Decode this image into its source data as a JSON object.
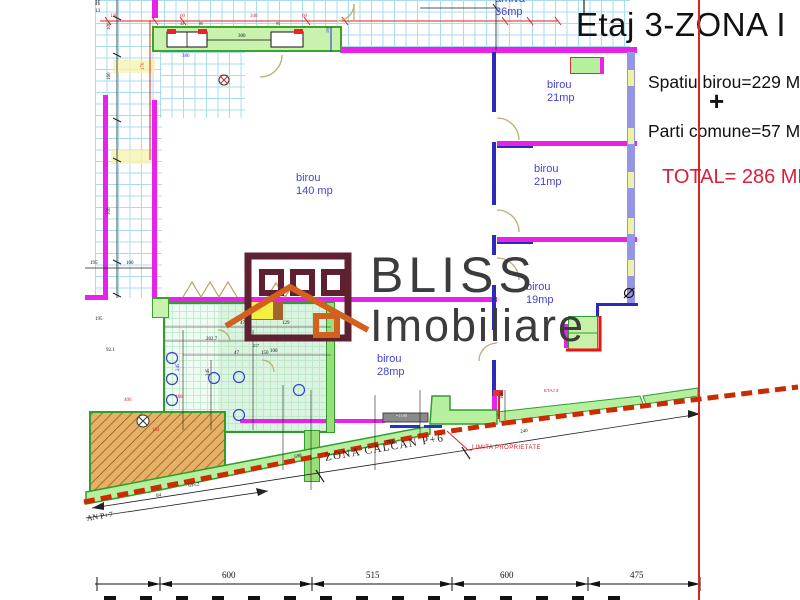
{
  "palette": {
    "magenta": "#e822e8",
    "wallblue": "#2b2bb8",
    "periwinkle": "#9595e6",
    "window": "#eef2a4",
    "grid": "#aadcf0",
    "tile": "#c5ecd0",
    "greenwall": "#b6ef9e",
    "greenborder": "#2f9e2f",
    "red": "#dd2222",
    "dashred": "#cc2a00",
    "tan": "#bfae74",
    "labelblue": "#4343cf",
    "maroon": "#5f2030",
    "orange": "#d2601e",
    "graytext": "#3c3c3c",
    "stairs": "#e5b167",
    "yellow": "#f3ef43"
  },
  "title_block": {
    "title": "Etaj 3-ZONA I",
    "line1": "Spatiu birou=229 MP",
    "plus": "+",
    "line2": "Parti comune=57 MP",
    "total": "TOTAL= 286 MP"
  },
  "watermark": {
    "brand": "BLISS",
    "brand2": "Imobiliare"
  },
  "rooms": [
    {
      "name": "arhiva",
      "area": "36mp"
    },
    {
      "name": "birou",
      "area": "21mp"
    },
    {
      "name": "birou",
      "area": "21mp"
    },
    {
      "name": "birou",
      "area": "19mp"
    },
    {
      "name": "birou",
      "area": "140 mp"
    },
    {
      "name": "birou",
      "area": "28mp"
    }
  ],
  "zone_labels": {
    "calcan": "ZONA CALCAN P+6",
    "limita": "LIMITA PROPRIETATE",
    "an_p7": "AN P+7",
    "etaj": "ETAJ 3"
  },
  "bottom_dims": [
    "600",
    "515",
    "600",
    "475"
  ],
  "annotations": [
    {
      "t": "H",
      "x": 95,
      "y": 0,
      "c": "#111",
      "s": 7
    },
    {
      "t": "13",
      "x": 95,
      "y": 9,
      "c": "#111",
      "s": 5
    },
    {
      "t": "130",
      "x": 110,
      "y": 14,
      "c": "#dd2222",
      "s": 5
    },
    {
      "t": "60",
      "x": 180,
      "y": 14,
      "c": "#dd2222",
      "s": 5
    },
    {
      "t": "346",
      "x": 250,
      "y": 14,
      "c": "#dd2222",
      "s": 5
    },
    {
      "t": "60",
      "x": 302,
      "y": 14,
      "c": "#dd2222",
      "s": 5
    },
    {
      "t": "300",
      "x": 238,
      "y": 34,
      "c": "#111",
      "s": 5
    },
    {
      "t": "43",
      "x": 180,
      "y": 22,
      "c": "#111",
      "s": 4
    },
    {
      "t": "85",
      "x": 199,
      "y": 22,
      "c": "#111",
      "s": 4
    },
    {
      "t": "95",
      "x": 276,
      "y": 22,
      "c": "#111",
      "s": 4
    },
    {
      "t": "170",
      "x": 141,
      "y": 70,
      "c": "#dd2222",
      "s": 5,
      "r": -90
    },
    {
      "t": "380",
      "x": 182,
      "y": 54,
      "c": "#2233cc",
      "s": 5
    },
    {
      "t": "100",
      "x": 107,
      "y": 30,
      "c": "#111",
      "s": 5,
      "r": -90
    },
    {
      "t": "160",
      "x": 107,
      "y": 80,
      "c": "#111",
      "s": 5,
      "r": -90
    },
    {
      "t": "100",
      "x": 107,
      "y": 215,
      "c": "#111",
      "s": 5,
      "r": -90
    },
    {
      "t": "100",
      "x": 326,
      "y": 33,
      "c": "#2233cc",
      "s": 4,
      "r": -90
    },
    {
      "t": "195",
      "x": 90,
      "y": 261,
      "c": "#111",
      "s": 5
    },
    {
      "t": "100",
      "x": 126,
      "y": 261,
      "c": "#111",
      "s": 5
    },
    {
      "t": "470",
      "x": 240,
      "y": 321,
      "c": "#111",
      "s": 5
    },
    {
      "t": "202.7",
      "x": 206,
      "y": 337,
      "c": "#111",
      "s": 5
    },
    {
      "t": "80",
      "x": 256,
      "y": 337,
      "c": "#111",
      "s": 5
    },
    {
      "t": "217",
      "x": 253,
      "y": 344,
      "c": "#111",
      "s": 4
    },
    {
      "t": "47",
      "x": 234,
      "y": 351,
      "c": "#111",
      "s": 5
    },
    {
      "t": "150",
      "x": 261,
      "y": 351,
      "c": "#111",
      "s": 5
    },
    {
      "t": "129",
      "x": 282,
      "y": 321,
      "c": "#111",
      "s": 5
    },
    {
      "t": "100",
      "x": 270,
      "y": 349,
      "c": "#111",
      "s": 5
    },
    {
      "t": "345",
      "x": 206,
      "y": 376,
      "c": "#111",
      "s": 5,
      "r": -90
    },
    {
      "t": "245",
      "x": 176,
      "y": 371,
      "c": "#2233cc",
      "s": 5,
      "r": -90
    },
    {
      "t": "92.1",
      "x": 106,
      "y": 348,
      "c": "#111",
      "s": 5
    },
    {
      "t": "195",
      "x": 95,
      "y": 317,
      "c": "#111",
      "s": 5
    },
    {
      "t": "400",
      "x": 124,
      "y": 398,
      "c": "#dd2222",
      "s": 5
    },
    {
      "t": "166",
      "x": 175,
      "y": 395,
      "c": "#dd2222",
      "s": 5
    },
    {
      "t": "104",
      "x": 152,
      "y": 428,
      "c": "#dd2222",
      "s": 5
    },
    {
      "t": "=11.00",
      "x": 396,
      "y": 414,
      "c": "#f2f2f2",
      "s": 4
    },
    {
      "t": "100",
      "x": 500,
      "y": 399,
      "c": "#111",
      "s": 5,
      "r": -90
    },
    {
      "t": "698",
      "x": 294,
      "y": 455,
      "c": "#111",
      "s": 5,
      "r": -9
    },
    {
      "t": "794",
      "x": 386,
      "y": 441,
      "c": "#111",
      "s": 5,
      "r": -9
    },
    {
      "t": "100",
      "x": 405,
      "y": 437,
      "c": "#dd2222",
      "s": 5,
      "r": -9
    },
    {
      "t": "240",
      "x": 520,
      "y": 430,
      "c": "#111",
      "s": 5,
      "r": -9
    },
    {
      "t": "84",
      "x": 156,
      "y": 494,
      "c": "#111",
      "s": 5,
      "r": -9
    },
    {
      "t": "695.2",
      "x": 188,
      "y": 484,
      "c": "#111",
      "s": 5,
      "r": -9
    }
  ]
}
